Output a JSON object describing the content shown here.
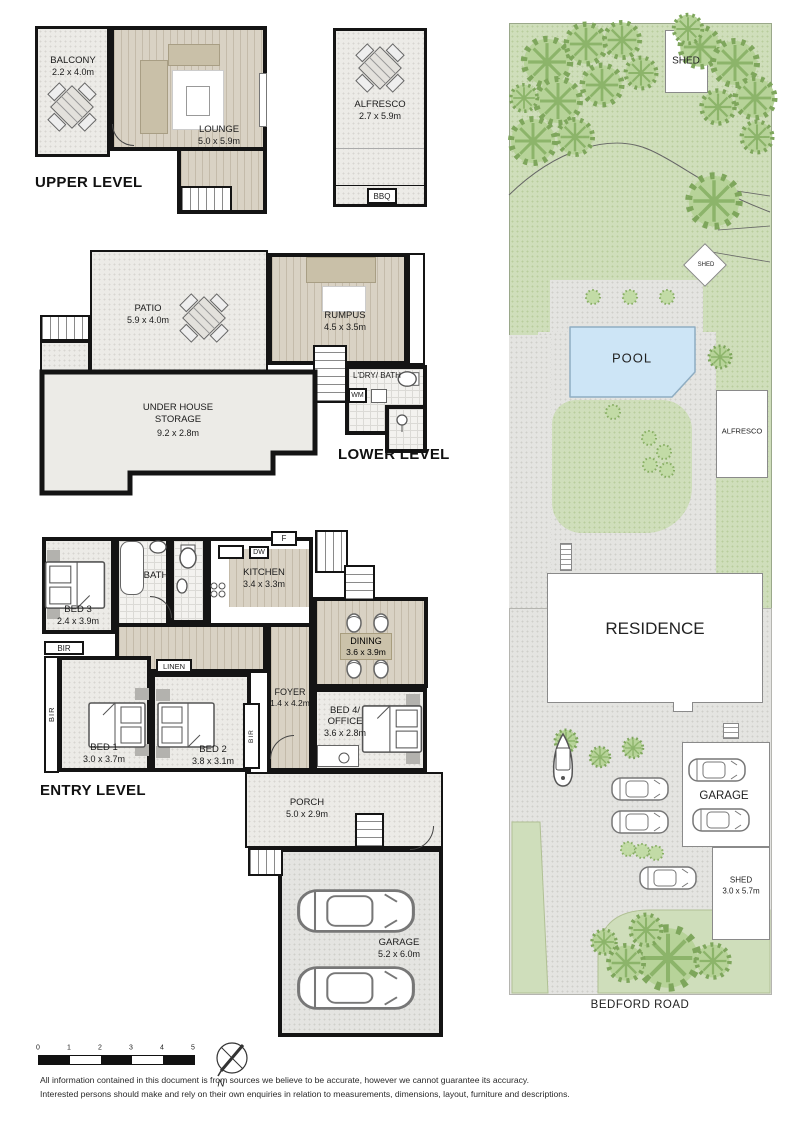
{
  "upper": {
    "title": "UPPER LEVEL",
    "balcony": {
      "name": "BALCONY",
      "dims": "2.2 x 4.0m"
    },
    "lounge": {
      "name": "LOUNGE",
      "dims": "5.0 x 5.9m"
    },
    "alfresco": {
      "name": "ALFRESCO",
      "dims": "2.7 x 5.9m"
    },
    "bbq": "BBQ"
  },
  "lower": {
    "title": "LOWER LEVEL",
    "patio": {
      "name": "PATIO",
      "dims": "5.9 x 4.0m"
    },
    "rumpus": {
      "name": "RUMPUS",
      "dims": "4.5 x 3.5m"
    },
    "laundry": {
      "name": "L'DRY/ BATH"
    },
    "wm": "WM",
    "storage": {
      "name": "UNDER HOUSE\nSTORAGE",
      "dims": "9.2 x 2.8m"
    }
  },
  "entry": {
    "title": "ENTRY LEVEL",
    "bed3": {
      "name": "BED 3",
      "dims": "2.4 x 3.9m"
    },
    "bath": {
      "name": "BATH"
    },
    "kitchen": {
      "name": "KITCHEN",
      "dims": "3.4 x 3.3m"
    },
    "fridge": "F",
    "dishwasher": "DW",
    "dining": {
      "name": "DINING",
      "dims": "3.6 x 3.9m"
    },
    "linen": "LINEN",
    "bir": "BIR",
    "bed1": {
      "name": "BED 1",
      "dims": "3.0 x 3.7m"
    },
    "bed2": {
      "name": "BED 2",
      "dims": "3.8 x 3.1m"
    },
    "foyer": {
      "name": "FOYER",
      "dims": "1.4 x 4.2m"
    },
    "bed4": {
      "name": "BED 4/",
      "name2": "OFFICE",
      "dims": "3.6 x 2.8m"
    },
    "porch": {
      "name": "PORCH",
      "dims": "5.0 x 2.9m"
    },
    "garage": {
      "name": "GARAGE",
      "dims": "5.2 x 6.0m"
    }
  },
  "site": {
    "shed_top": "SHED",
    "shed_small": "SHED",
    "pool": "POOL",
    "alfresco": "ALFRESCO",
    "residence": "RESIDENCE",
    "garage": "GARAGE",
    "shed_bottom": {
      "name": "SHED",
      "dims": "3.0 x 5.7m"
    },
    "road": "BEDFORD ROAD"
  },
  "footer": {
    "scale_ticks": [
      "0",
      "1",
      "2",
      "3",
      "4",
      "5"
    ],
    "north": "N",
    "disclaimer1": "All information contained in this document is from sources we believe to be accurate, however we cannot guarantee its accuracy.",
    "disclaimer2": "Interested persons should make and rely on their own enquiries in relation to measurements, dimensions, layout, furniture and descriptions."
  },
  "colors": {
    "wall": "#141414",
    "floor": "#ecebe7",
    "timber": "#d9d2c4",
    "furniture_tan": "#c9c0a8",
    "site_green": "#cfdebb",
    "tree_green": "#b7d399",
    "pool_blue": "#cde5f6",
    "driveway_gray": "#e4e4e1"
  }
}
